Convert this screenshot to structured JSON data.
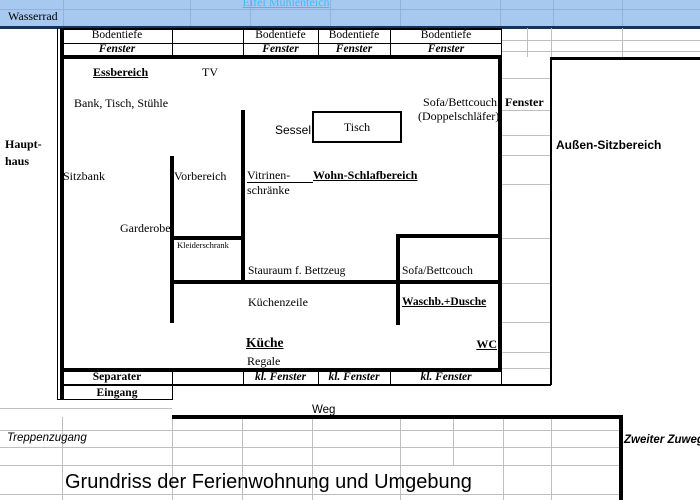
{
  "colors": {
    "top_band": "#A8C9EF",
    "top_band_grid": "#8FB3DC",
    "link_text": "#38C0F0",
    "navy_rule": "#17335C",
    "grid_gray": "#BFBFBF",
    "wall": "#000000",
    "background": "#FFFFFF"
  },
  "header_band": {
    "link_text": "Eifel Mühlenteich",
    "row_label": "Wasserrad"
  },
  "window_header": {
    "cells": [
      {
        "top": "Bodentiefe",
        "bottom": "Fenster"
      },
      {
        "top": "Bodentiefe",
        "bottom": "Fenster"
      },
      {
        "top": "Bodentiefe",
        "bottom": "Fenster"
      },
      {
        "top": "Bodentiefe",
        "bottom": "Fenster"
      }
    ]
  },
  "plan": {
    "haupthaus_line1": "Haupt-",
    "haupthaus_line2": "haus",
    "essbereich": "Essbereich",
    "tv": "TV",
    "bank_tisch_stuehle": "Bank, Tisch, Stühle",
    "sofa_bettcouch_1": "Sofa/Bettcouch",
    "doppelschlaefer": "(Doppelschläfer)",
    "fenster_side": "Fenster",
    "sessel": "Sessel",
    "tisch": "Tisch",
    "sitzbank": "Sitzbank",
    "vorbereich": "Vorbereich",
    "vitrinen_line1": "Vitrinen-",
    "vitrinen_line2": "schränke",
    "wohn_schlafbereich": "Wohn-Schlafbereich",
    "garderobe": "Garderobe",
    "kleiderschrank": "Kleiderschrank",
    "stauraum": "Stauraum f. Bettzeug",
    "sofa_bettcouch_2": "Sofa/Bettcouch",
    "kuechenzeile": "Küchenzeile",
    "waschbecken_dusche": "Waschb.+Dusche",
    "kueche": "Küche",
    "wc": "WC",
    "regale": "Regale"
  },
  "outside": {
    "aussen_sitzbereich": "Außen-Sitzbereich",
    "separater": "Separater",
    "eingang": "Eingang",
    "kl_fenster": [
      "kl. Fenster",
      "kl. Fenster",
      "kl. Fenster"
    ],
    "weg": "Weg",
    "treppenzugang": "Treppenzugang",
    "zweiter_zuweg": "Zweiter Zuweg"
  },
  "title": "Grundriss der Ferienwohnung und Umgebung"
}
